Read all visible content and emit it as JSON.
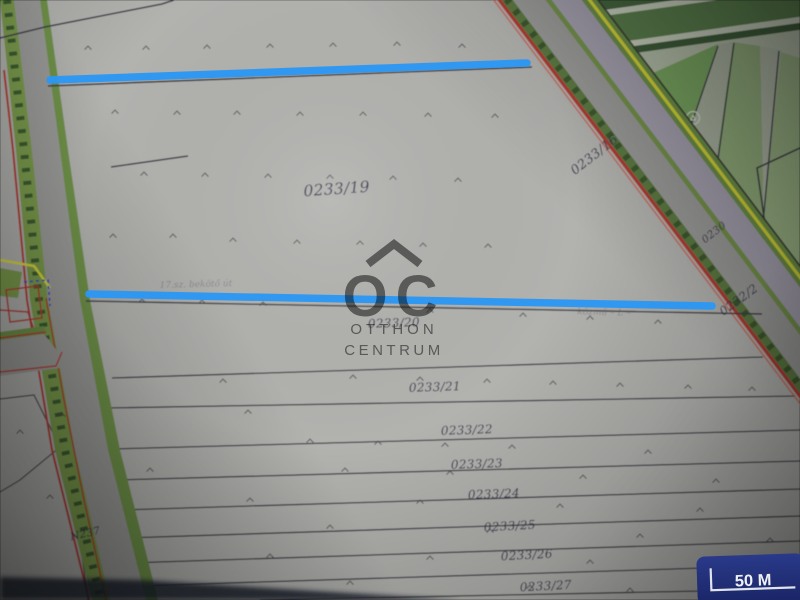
{
  "app": {
    "type": "cadastral-map-photo",
    "description": "photo of cadastral parcel map with drawn annotations"
  },
  "colors": {
    "paper": "#b2b2af",
    "boundary": "#3f3f48",
    "label": "#373750",
    "road_left": "#9b9b99",
    "lavender": "#a6a2b0",
    "hedge": "#7c9c4e",
    "hedge_dark": "#34512b",
    "road_green": "#6f9348",
    "yellow": "#d8d838",
    "red": "#b23b30",
    "red_orange": "#cf5540",
    "sector_base": "#6a8f5f",
    "band_dark": "#47693f",
    "band_mid": "#5d8250",
    "band_pale_line": "#cdd5c2",
    "band_dark2": "#3f5f3a",
    "band_pale": "#b7c1ab",
    "parcel_bright": "#7ca963",
    "parcel_light": "#8fb573",
    "fan_pale": "#adb6a3",
    "fan_green": "#94b07e",
    "fan_pale2": "#b2baa8",
    "fan_green2": "#9db687",
    "tree": "#d4dcc6",
    "mark": "#4a4a50",
    "dark_band": "#1a202e",
    "blue": "#2a97f5",
    "watermark": "#6c6c6c",
    "scale_bg1": "#2a3a8a",
    "scale_bg2": "#1a2566",
    "scale_line": "#dfe3ea",
    "scale_text": "#eef0f5"
  },
  "map": {
    "labels": [
      {
        "text": "0233/19",
        "x": 337,
        "y": 194,
        "rot": -4,
        "size": 15.5
      },
      {
        "text": "0233/16",
        "x": 597,
        "y": 158,
        "rot": -38,
        "size": 13
      },
      {
        "text": "0230",
        "x": 716,
        "y": 235,
        "rot": -38,
        "size": 10.5
      },
      {
        "text": "0232/2",
        "x": 741,
        "y": 303,
        "rot": -36,
        "size": 12
      },
      {
        "text": "0233/20",
        "x": 394,
        "y": 327,
        "rot": -2,
        "size": 12
      },
      {
        "text": "0233/21",
        "x": 435,
        "y": 391,
        "rot": -2,
        "size": 12
      },
      {
        "text": "0233/22",
        "x": 467,
        "y": 434,
        "rot": -2,
        "size": 12
      },
      {
        "text": "0233/23",
        "x": 477,
        "y": 468,
        "rot": -2,
        "size": 12
      },
      {
        "text": "0233/24",
        "x": 494,
        "y": 498,
        "rot": -2,
        "size": 12
      },
      {
        "text": "0233/25",
        "x": 510,
        "y": 530,
        "rot": -3,
        "size": 12
      },
      {
        "text": "0233/26",
        "x": 527,
        "y": 559,
        "rot": -3,
        "size": 12
      },
      {
        "text": "0233/27",
        "x": 546,
        "y": 590,
        "rot": -3,
        "size": 12
      },
      {
        "text": "N237",
        "x": 86,
        "y": 537,
        "rot": -13,
        "size": 10.5
      }
    ],
    "faint_texts": [
      {
        "text": "17.sz. bekötő út",
        "x": 196,
        "y": 287,
        "rot": -1.5,
        "size": 9,
        "opacity": 0.3
      },
      {
        "text": "közmű – L –",
        "x": 604,
        "y": 315,
        "rot": 1,
        "size": 9,
        "opacity": 0.28
      }
    ],
    "survey_marks": [
      [
        88,
        48
      ],
      [
        146,
        48
      ],
      [
        207,
        47
      ],
      [
        270,
        46
      ],
      [
        333,
        45
      ],
      [
        397,
        44
      ],
      [
        462,
        46
      ],
      [
        115,
        112
      ],
      [
        177,
        113
      ],
      [
        237,
        113
      ],
      [
        300,
        114
      ],
      [
        363,
        114
      ],
      [
        428,
        115
      ],
      [
        495,
        116
      ],
      [
        144,
        174
      ],
      [
        205,
        175
      ],
      [
        268,
        176
      ],
      [
        330,
        177
      ],
      [
        393,
        178
      ],
      [
        458,
        180
      ],
      [
        113,
        236
      ],
      [
        173,
        236
      ],
      [
        233,
        240
      ],
      [
        297,
        242
      ],
      [
        360,
        243
      ],
      [
        423,
        245
      ],
      [
        488,
        246
      ],
      [
        142,
        301
      ],
      [
        202,
        302
      ],
      [
        263,
        304
      ],
      [
        430,
        311
      ],
      [
        523,
        315
      ],
      [
        590,
        318
      ],
      [
        658,
        322
      ],
      [
        223,
        381
      ],
      [
        353,
        377
      ],
      [
        420,
        379
      ],
      [
        487,
        381
      ],
      [
        553,
        383
      ],
      [
        620,
        385
      ],
      [
        688,
        387
      ],
      [
        752,
        389
      ],
      [
        62,
        415
      ],
      [
        248,
        412
      ],
      [
        310,
        441
      ],
      [
        378,
        443
      ],
      [
        445,
        445
      ],
      [
        512,
        447
      ],
      [
        648,
        452
      ],
      [
        150,
        470
      ],
      [
        345,
        470
      ],
      [
        450,
        473
      ],
      [
        583,
        477
      ],
      [
        716,
        481
      ],
      [
        250,
        500
      ],
      [
        420,
        502
      ],
      [
        560,
        506
      ],
      [
        700,
        510
      ],
      [
        330,
        527
      ],
      [
        490,
        531
      ],
      [
        640,
        536
      ],
      [
        770,
        540
      ],
      [
        270,
        556
      ],
      [
        430,
        558
      ],
      [
        590,
        562
      ],
      [
        740,
        566
      ],
      [
        350,
        583
      ],
      [
        530,
        587
      ],
      [
        630,
        590
      ],
      [
        20,
        432
      ],
      [
        50,
        497
      ]
    ],
    "tree_symbols": [
      [
        645,
        116
      ],
      [
        693,
        118
      ],
      [
        768,
        252
      ]
    ]
  },
  "annotations": {
    "color": "#2a97f5",
    "width": 7.5,
    "lines": [
      {
        "x1": 50,
        "y1": 80,
        "x2": 527,
        "y2": 63
      },
      {
        "x1": 89,
        "y1": 294,
        "x2": 712,
        "y2": 306
      }
    ]
  },
  "watermark": {
    "initials": "OC",
    "line1": "OTTHON",
    "line2": "CENTRUM"
  },
  "scale_bar": {
    "label": "50 M"
  }
}
